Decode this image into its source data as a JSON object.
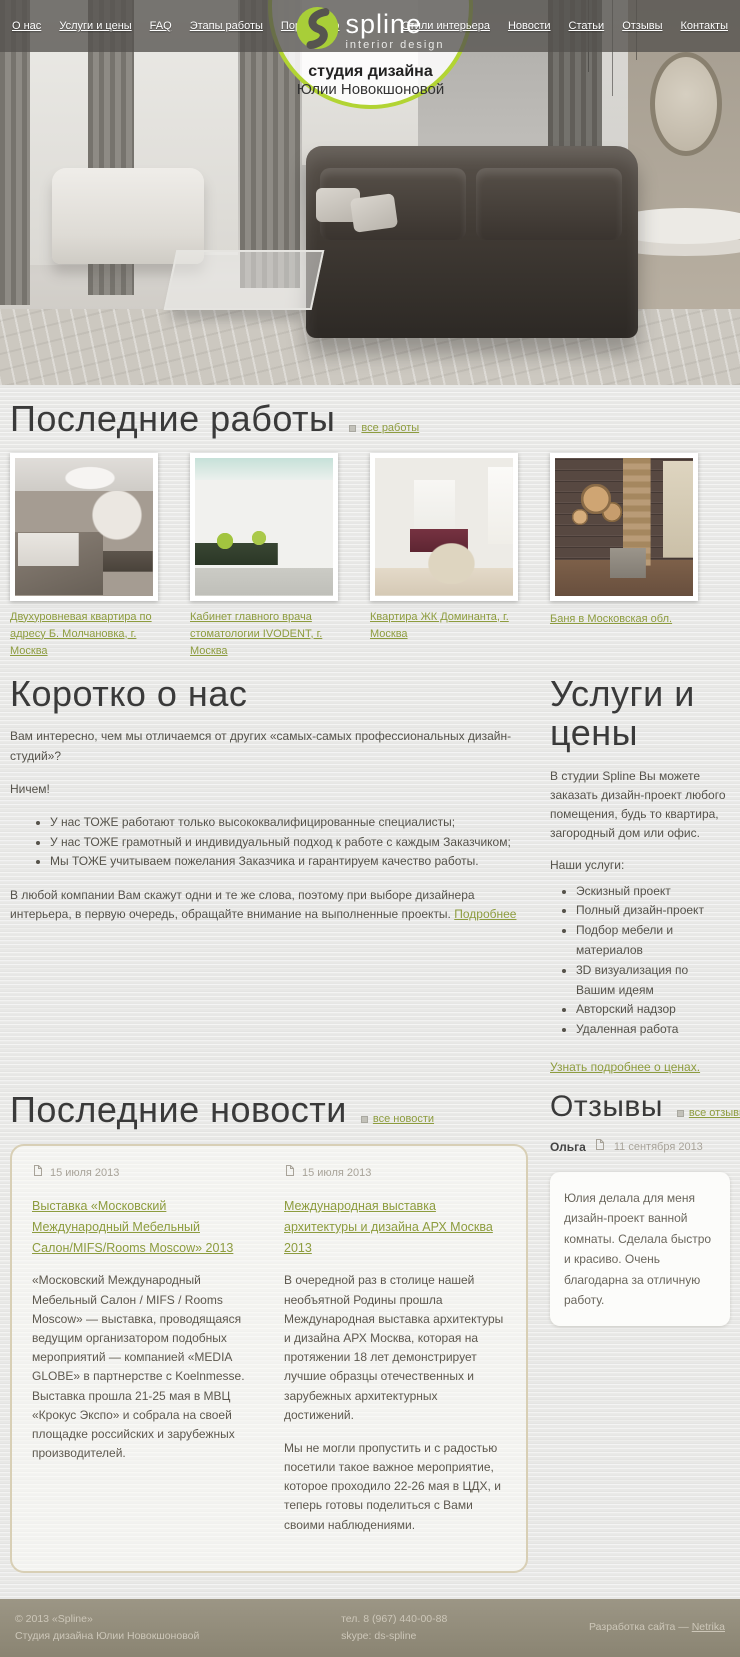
{
  "brand": {
    "logo_text": "spline",
    "logo_subtext": "interior design",
    "badge_line1": "студия дизайна",
    "badge_line2": "Юлии Новокшоновой",
    "accent_color": "#b2d433",
    "link_color": "#8d9c3e"
  },
  "nav": {
    "items": [
      "О нас",
      "Услуги и цены",
      "FAQ",
      "Этапы работы",
      "Портфолио",
      "Стили интерьера",
      "Новости",
      "Статьи",
      "Отзывы",
      "Контакты"
    ]
  },
  "works": {
    "title": "Последние работы",
    "all_link": "все работы",
    "items": [
      {
        "caption": "Двухуровневая квартира по адресу Б. Молчановка, г. Москва"
      },
      {
        "caption": "Кабинет главного врача стоматологии IVODENT, г. Москва"
      },
      {
        "caption": "Квартира ЖК Доминанта, г. Москва"
      },
      {
        "caption": "Баня в Московская обл."
      }
    ]
  },
  "about": {
    "title": "Коротко о нас",
    "p1": "Вам интересно, чем мы отличаемся от других «самых-самых профессиональных дизайн-студий»?",
    "p2": "Ничем!",
    "bullets": [
      "У нас ТОЖЕ работают только высококвалифицированные специалисты;",
      "У нас ТОЖЕ грамотный и индивидуальный подход к работе с каждым Заказчиком;",
      "Мы ТОЖЕ учитываем пожелания Заказчика и гарантируем качество работы."
    ],
    "p3": "В любой компании Вам скажут одни и те же слова, поэтому при выборе дизайнера интерьера, в первую очередь, обращайте внимание на выполненные проекты.",
    "p3_link": "Подробнее"
  },
  "services": {
    "title": "Услуги и цены",
    "intro": "В студии Spline Вы можете заказать дизайн-проект любого помещения, будь то квартира, загородный дом или офис.",
    "list_label": "Наши услуги:",
    "items": [
      "Эскизный проект",
      "Полный дизайн-проект",
      "Подбор мебели и материалов",
      "3D визуализация по Вашим идеям",
      "Авторский надзор",
      "Удаленная работа"
    ],
    "link": "Узнать подробнее о ценах."
  },
  "news": {
    "title": "Последние новости",
    "all_link": "все новости",
    "items": [
      {
        "date": "15 июля 2013",
        "title": "Выставка «Московский Международный Мебельный Салон/MIFS/Rooms Moscow» 2013",
        "paragraphs": [
          "«Московский Международный Мебельный Салон / MIFS / Rooms Moscow» — выставка, проводящаяся ведущим организатором подобных мероприятий — компанией «MEDIA GLOBE» в партнерстве с Koelnmesse. Выставка прошла 21-25 мая в МВЦ «Крокус Экспо» и собрала на своей площадке российских и зарубежных производителей."
        ]
      },
      {
        "date": "15 июля 2013",
        "title": "Международная выставка архитектуры и дизайна АРХ Москва 2013",
        "paragraphs": [
          "В очередной раз в столице нашей необъятной Родины прошла Международная выставка архитектуры и дизайна АРХ Москва, которая на протяжении 18 лет демонстрирует лучшие образцы отечественных и зарубежных архитектурных достижений.",
          "Мы не могли пропустить и с радостью посетили такое важное мероприятие, которое проходило 22-26 мая в ЦДХ, и теперь готовы поделиться с Вами своими наблюдениями."
        ]
      }
    ]
  },
  "reviews": {
    "title": "Отзывы",
    "all_link": "все отзывы",
    "items": [
      {
        "author": "Ольга",
        "date": "11 сентября 2013",
        "text": "Юлия делала для меня дизайн-проект ванной комнаты. Сделала быстро и красиво. Очень благодарна за отличную работу."
      }
    ]
  },
  "footer": {
    "copyright": "© 2013 «Spline»",
    "studio": "Студия дизайна Юлии Новокшоновой",
    "phone": "тел. 8 (967) 440-00-88",
    "skype": "skype: ds-spline",
    "dev_before": "Разработка сайта — ",
    "dev_link": "Netrika"
  }
}
